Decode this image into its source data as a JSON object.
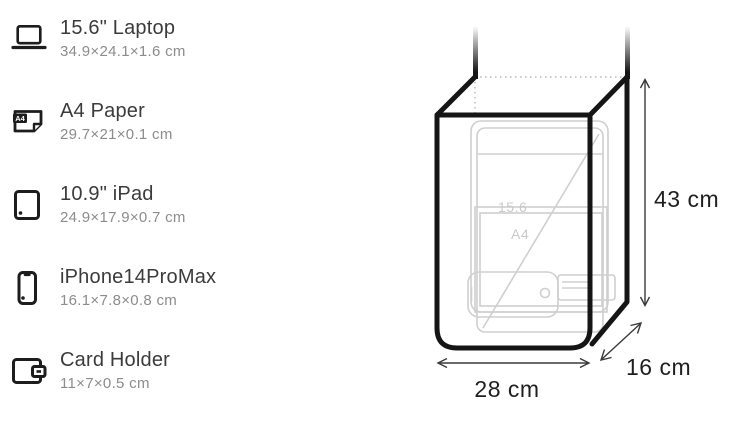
{
  "figure": {
    "title": "bag capacity and dimensions diagram"
  },
  "items": [
    {
      "icon": "laptop-icon",
      "name": "15.6\" Laptop",
      "dims": "34.9×24.1×1.6 cm"
    },
    {
      "icon": "a4-paper-icon",
      "name": "A4 Paper",
      "dims": "29.7×21×0.1 cm"
    },
    {
      "icon": "ipad-icon",
      "name": "10.9\" iPad",
      "dims": "24.9×17.9×0.7 cm"
    },
    {
      "icon": "iphone-icon",
      "name": "iPhone14ProMax",
      "dims": "16.1×7.8×0.8 cm"
    },
    {
      "icon": "card-holder-icon",
      "name": "Card Holder",
      "dims": "11×7×0.5 cm"
    }
  ],
  "icon_badges": {
    "a4_label": "A4"
  },
  "diagram": {
    "height_label": "43 cm",
    "width_label": "28 cm",
    "depth_label": "16 cm",
    "inner_labels": {
      "laptop": "15.6",
      "a4": "A4"
    },
    "colors": {
      "bag_outline": "#151515",
      "item_outline": "#cfcfcf",
      "dimension_lines": "#3a3a3a",
      "dimension_text": "#1f1f1f",
      "hidden_edge_dotted": "#b8b8b8",
      "faint_item_text": "#c9c9c9"
    }
  }
}
